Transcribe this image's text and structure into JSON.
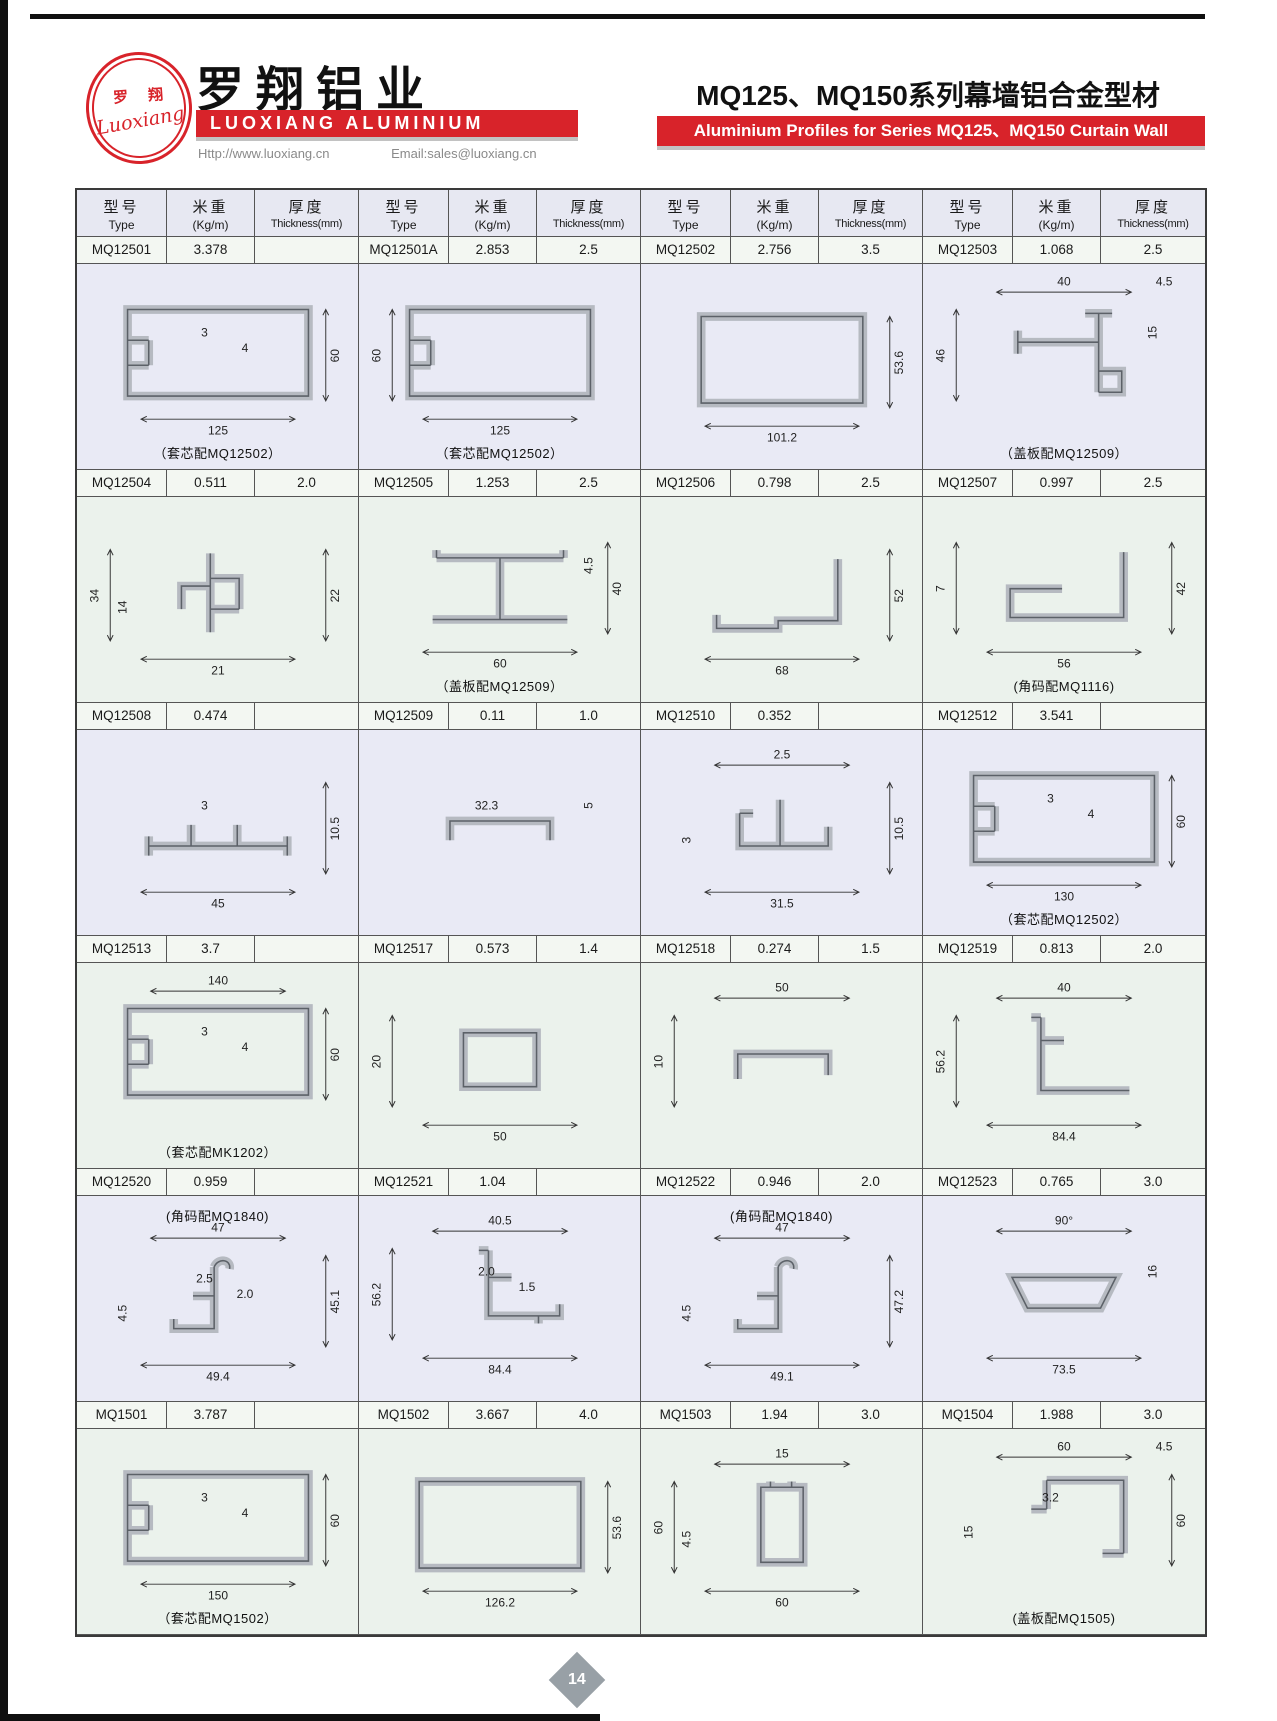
{
  "header": {
    "logo_zh": "罗 翔",
    "logo_script": "Luoxiang",
    "company_zh": "罗翔铝业",
    "company_en": "LUOXIANG ALUMINIUM",
    "website": "Http://www.luoxiang.cn",
    "email": "Email:sales@luoxiang.cn",
    "title_zh": "MQ125、MQ150系列幕墙铝合金型材",
    "title_en": "Aluminium Profiles for Series MQ125、MQ150 Curtain Wall",
    "accent_red": "#d8232a"
  },
  "table": {
    "col_headers": {
      "type_zh": "型号",
      "type_en": "Type",
      "weight_zh": "米重",
      "weight_en": "(Kg/m)",
      "thick_zh": "厚度",
      "thick_en": "Thickness(mm)"
    },
    "rows": [
      {
        "tint": "lav",
        "items": [
          {
            "type": "MQ12501",
            "kg": "3.378",
            "th": "",
            "shape": "hrectNotch",
            "dims": [
              {
                "l": "3",
                "s": "in"
              },
              {
                "l": "4",
                "s": "in"
              },
              {
                "l": "60",
                "s": "right"
              },
              {
                "l": "125",
                "s": "bottom"
              }
            ],
            "caption": "（套芯配MQ12502）",
            "cpos": "bottom"
          },
          {
            "type": "MQ12501A",
            "kg": "2.853",
            "th": "2.5",
            "shape": "hrectNotch",
            "dims": [
              {
                "l": "60",
                "s": "left"
              },
              {
                "l": "125",
                "s": "bottom"
              }
            ],
            "caption": "（套芯配MQ12502）",
            "cpos": "bottom"
          },
          {
            "type": "MQ12502",
            "kg": "2.756",
            "th": "3.5",
            "shape": "vrect",
            "dims": [
              {
                "l": "53.6",
                "s": "right"
              },
              {
                "l": "101.2",
                "s": "bottom"
              }
            ],
            "caption": "",
            "cpos": "bottom"
          },
          {
            "type": "MQ12503",
            "kg": "1.068",
            "th": "2.5",
            "shape": "teeR",
            "dims": [
              {
                "l": "40",
                "s": "top"
              },
              {
                "l": "4.5",
                "s": "top2"
              },
              {
                "l": "46",
                "s": "left"
              },
              {
                "l": "15",
                "s": "right2"
              }
            ],
            "caption": "（盖板配MQ12509）",
            "cpos": "bottom"
          }
        ]
      },
      {
        "tint": "grn",
        "items": [
          {
            "type": "MQ12504",
            "kg": "0.511",
            "th": "2.0",
            "shape": "clip",
            "dims": [
              {
                "l": "34",
                "s": "left"
              },
              {
                "l": "14",
                "s": "left2"
              },
              {
                "l": "22",
                "s": "right"
              },
              {
                "l": "21",
                "s": "bottom"
              }
            ],
            "caption": "",
            "cpos": "bottom"
          },
          {
            "type": "MQ12505",
            "kg": "1.253",
            "th": "2.5",
            "shape": "ibeam",
            "dims": [
              {
                "l": "4.5",
                "s": "right2"
              },
              {
                "l": "40",
                "s": "right"
              },
              {
                "l": "60",
                "s": "bottom"
              }
            ],
            "caption": "（盖板配MQ12509）",
            "cpos": "bottom"
          },
          {
            "type": "MQ12506",
            "kg": "0.798",
            "th": "2.5",
            "shape": "zstep",
            "dims": [
              {
                "l": "52",
                "s": "right"
              },
              {
                "l": "68",
                "s": "bottom"
              }
            ],
            "caption": "",
            "cpos": "bottom"
          },
          {
            "type": "MQ12507",
            "kg": "0.997",
            "th": "2.5",
            "shape": "ltray",
            "dims": [
              {
                "l": "7",
                "s": "left"
              },
              {
                "l": "42",
                "s": "right"
              },
              {
                "l": "56",
                "s": "bottom"
              }
            ],
            "caption": "(角码配MQ1116)",
            "cpos": "bottom"
          }
        ]
      },
      {
        "tint": "lav",
        "items": [
          {
            "type": "MQ12508",
            "kg": "0.474",
            "th": "",
            "shape": "flatTabs",
            "dims": [
              {
                "l": "3",
                "s": "in"
              },
              {
                "l": "10.5",
                "s": "right"
              },
              {
                "l": "45",
                "s": "bottom"
              }
            ],
            "caption": "",
            "cpos": "bottom"
          },
          {
            "type": "MQ12509",
            "kg": "0.11",
            "th": "1.0",
            "shape": "shChan",
            "dims": [
              {
                "l": "32.3",
                "s": "in"
              },
              {
                "l": "5",
                "s": "right2"
              }
            ],
            "caption": "",
            "cpos": "bottom"
          },
          {
            "type": "MQ12510",
            "kg": "0.352",
            "th": "",
            "shape": "hat",
            "dims": [
              {
                "l": "2.5",
                "s": "top"
              },
              {
                "l": "10.5",
                "s": "right"
              },
              {
                "l": "3",
                "s": "left2"
              },
              {
                "l": "31.5",
                "s": "bottom"
              }
            ],
            "caption": "",
            "cpos": "bottom"
          },
          {
            "type": "MQ12512",
            "kg": "3.541",
            "th": "",
            "shape": "hrectNotch",
            "dims": [
              {
                "l": "3",
                "s": "in"
              },
              {
                "l": "4",
                "s": "in"
              },
              {
                "l": "60",
                "s": "right"
              },
              {
                "l": "130",
                "s": "bottom"
              }
            ],
            "caption": "（套芯配MQ12502）",
            "cpos": "bottom"
          }
        ]
      },
      {
        "tint": "grn",
        "items": [
          {
            "type": "MQ12513",
            "kg": "3.7",
            "th": "",
            "shape": "hrectNotch",
            "dims": [
              {
                "l": "140",
                "s": "top"
              },
              {
                "l": "3",
                "s": "in"
              },
              {
                "l": "4",
                "s": "in"
              },
              {
                "l": "60",
                "s": "right"
              }
            ],
            "caption": "（套芯配MK1202）",
            "cpos": "bottom"
          },
          {
            "type": "MQ12517",
            "kg": "0.573",
            "th": "1.4",
            "shape": "srect",
            "dims": [
              {
                "l": "20",
                "s": "left"
              },
              {
                "l": "50",
                "s": "bottom"
              }
            ],
            "caption": "",
            "cpos": "bottom"
          },
          {
            "type": "MQ12518",
            "kg": "0.274",
            "th": "1.5",
            "shape": "chanDown",
            "dims": [
              {
                "l": "50",
                "s": "top"
              },
              {
                "l": "10",
                "s": "left"
              }
            ],
            "caption": "",
            "cpos": "bottom"
          },
          {
            "type": "MQ12519",
            "kg": "0.813",
            "th": "2.0",
            "shape": "lmull",
            "dims": [
              {
                "l": "40",
                "s": "top"
              },
              {
                "l": "56.2",
                "s": "left"
              },
              {
                "l": "84.4",
                "s": "bottom"
              }
            ],
            "caption": "",
            "cpos": "bottom"
          }
        ]
      },
      {
        "tint": "lav",
        "items": [
          {
            "type": "MQ12520",
            "kg": "0.959",
            "th": "",
            "shape": "hook",
            "dims": [
              {
                "l": "47",
                "s": "top"
              },
              {
                "l": "2.5",
                "s": "in"
              },
              {
                "l": "2.0",
                "s": "in"
              },
              {
                "l": "45.1",
                "s": "right"
              },
              {
                "l": "4.5",
                "s": "left2"
              },
              {
                "l": "49.4",
                "s": "bottom"
              }
            ],
            "caption": "(角码配MQ1840)",
            "cpos": "top"
          },
          {
            "type": "MQ12521",
            "kg": "1.04",
            "th": "",
            "shape": "gutter",
            "dims": [
              {
                "l": "40.5",
                "s": "top"
              },
              {
                "l": "2.0",
                "s": "in"
              },
              {
                "l": "56.2",
                "s": "left"
              },
              {
                "l": "1.5",
                "s": "in"
              },
              {
                "l": "84.4",
                "s": "bottom"
              }
            ],
            "caption": "",
            "cpos": "bottom"
          },
          {
            "type": "MQ12522",
            "kg": "0.946",
            "th": "2.0",
            "shape": "hook",
            "dims": [
              {
                "l": "47",
                "s": "top"
              },
              {
                "l": "47.2",
                "s": "right"
              },
              {
                "l": "4.5",
                "s": "left2"
              },
              {
                "l": "49.1",
                "s": "bottom"
              }
            ],
            "caption": "(角码配MQ1840)",
            "cpos": "top"
          },
          {
            "type": "MQ12523",
            "kg": "0.765",
            "th": "3.0",
            "shape": "trap",
            "dims": [
              {
                "l": "90°",
                "s": "top"
              },
              {
                "l": "16",
                "s": "right2"
              },
              {
                "l": "73.5",
                "s": "bottom"
              }
            ],
            "caption": "",
            "cpos": "bottom"
          }
        ]
      },
      {
        "tint": "grn",
        "items": [
          {
            "type": "MQ1501",
            "kg": "3.787",
            "th": "",
            "shape": "hrectNotch",
            "dims": [
              {
                "l": "3",
                "s": "in"
              },
              {
                "l": "4",
                "s": "in"
              },
              {
                "l": "60",
                "s": "right"
              },
              {
                "l": "150",
                "s": "bottom"
              }
            ],
            "caption": "（套芯配MQ1502）",
            "cpos": "bottom"
          },
          {
            "type": "MQ1502",
            "kg": "3.667",
            "th": "4.0",
            "shape": "vrect",
            "dims": [
              {
                "l": "53.6",
                "s": "right"
              },
              {
                "l": "126.2",
                "s": "bottom"
              }
            ],
            "caption": "",
            "cpos": "bottom"
          },
          {
            "type": "MQ1503",
            "kg": "1.94",
            "th": "3.0",
            "shape": "vchan",
            "dims": [
              {
                "l": "15",
                "s": "top"
              },
              {
                "l": "4.5",
                "s": "left2"
              },
              {
                "l": "60",
                "s": "left"
              },
              {
                "l": "60",
                "s": "bottom"
              }
            ],
            "caption": "",
            "cpos": "bottom"
          },
          {
            "type": "MQ1504",
            "kg": "1.988",
            "th": "3.0",
            "shape": "corner",
            "dims": [
              {
                "l": "4.5",
                "s": "top2"
              },
              {
                "l": "60",
                "s": "top"
              },
              {
                "l": "15",
                "s": "left2"
              },
              {
                "l": "60",
                "s": "right"
              },
              {
                "l": "3.2",
                "s": "in"
              }
            ],
            "caption": "(盖板配MQ1505)",
            "cpos": "bottom"
          }
        ]
      }
    ]
  },
  "footer": {
    "page": "14"
  }
}
